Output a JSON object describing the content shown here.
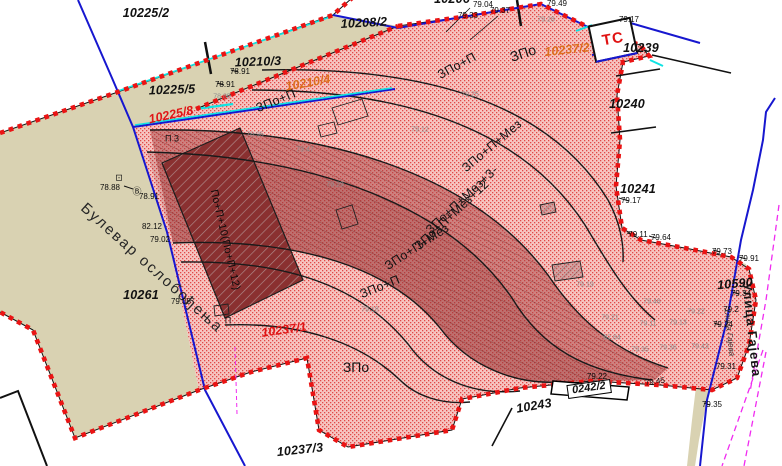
{
  "map": {
    "type": "cadastral-urban-plan",
    "colors": {
      "parcel_beige": "#d9d2b2",
      "plan_area_fill": "#f6c5c1",
      "plan_area_dots": "#e14848",
      "dense_zone_fill": "#a84040",
      "building_fill": "#8a3030",
      "boundary_dashes": "#ea1414",
      "cadastral_blue": "#1717cf",
      "cyan_line": "#0fe3e3",
      "magenta_line": "#f02bf0",
      "label_red": "#e01616",
      "label_orange": "#dc6e1c"
    },
    "labels": [
      {
        "t": "10225/2",
        "x": 146,
        "y": 13,
        "r": 0,
        "k": "p",
        "name": "parcel-label-10225-2"
      },
      {
        "t": "10206",
        "x": 452,
        "y": -1,
        "r": 0,
        "k": "p",
        "name": "parcel-label-10206-clipped"
      },
      {
        "t": "10208/2",
        "x": 364,
        "y": 23,
        "r": -3,
        "k": "p",
        "name": "parcel-label-10208-2"
      },
      {
        "t": "10210/3",
        "x": 258,
        "y": 62,
        "r": -2,
        "k": "p",
        "name": "parcel-label-10210-3"
      },
      {
        "t": "10225/5",
        "x": 172,
        "y": 90,
        "r": -2,
        "k": "p",
        "name": "parcel-label-10225-5"
      },
      {
        "t": "10225/8",
        "x": 171,
        "y": 115,
        "r": -12,
        "k": "pr",
        "name": "parcel-label-10225-8"
      },
      {
        "t": "10210/4",
        "x": 308,
        "y": 83,
        "r": -10,
        "k": "po",
        "name": "parcel-label-10210-4"
      },
      {
        "t": "10237/2",
        "x": 567,
        "y": 50,
        "r": -6,
        "k": "po",
        "name": "parcel-label-10237-2"
      },
      {
        "t": "10239",
        "x": 641,
        "y": 48,
        "r": 0,
        "k": "p",
        "name": "parcel-label-10239"
      },
      {
        "t": "10240",
        "x": 627,
        "y": 104,
        "r": 0,
        "k": "p",
        "name": "parcel-label-10240"
      },
      {
        "t": "10241",
        "x": 638,
        "y": 189,
        "r": 0,
        "k": "p",
        "name": "parcel-label-10241"
      },
      {
        "t": "10590",
        "x": 735,
        "y": 284,
        "r": -5,
        "k": "p",
        "name": "parcel-label-10590"
      },
      {
        "t": "10261",
        "x": 141,
        "y": 295,
        "r": 0,
        "k": "p",
        "name": "parcel-label-10261"
      },
      {
        "t": "10237/1",
        "x": 284,
        "y": 330,
        "r": -8,
        "k": "pr",
        "name": "parcel-label-10237-1"
      },
      {
        "t": "10237/3",
        "x": 300,
        "y": 450,
        "r": -6,
        "k": "p",
        "name": "parcel-label-10237-3"
      },
      {
        "t": "10243",
        "x": 534,
        "y": 406,
        "r": -10,
        "k": "p",
        "name": "parcel-label-10243"
      },
      {
        "t": "0242/2",
        "x": 589,
        "y": 389,
        "r": -8,
        "k": "bx",
        "name": "parcel-label-0242-2"
      },
      {
        "t": "ЗПо+П",
        "x": 276,
        "y": 101,
        "r": -22,
        "k": "z",
        "name": "zone-label"
      },
      {
        "t": "ЗПо+П",
        "x": 457,
        "y": 66,
        "r": -28,
        "k": "z",
        "name": "zone-label"
      },
      {
        "t": "ЗПо",
        "x": 523,
        "y": 53,
        "r": -18,
        "k": "zb",
        "name": "zone-label"
      },
      {
        "t": "ЗПо+П+Мез",
        "x": 492,
        "y": 146,
        "r": -40,
        "k": "z",
        "name": "zone-label"
      },
      {
        "t": "ЗПо+П+Мез+3-",
        "x": 462,
        "y": 200,
        "r": -43,
        "k": "z",
        "name": "zone-label"
      },
      {
        "t": "ЗПо+П+Мез+12",
        "x": 452,
        "y": 215,
        "r": -43,
        "k": "z",
        "name": "zone-label"
      },
      {
        "t": "ЗПо+П+Мез",
        "x": 417,
        "y": 247,
        "r": -33,
        "k": "z",
        "name": "zone-label"
      },
      {
        "t": "ЗПо+П",
        "x": 380,
        "y": 287,
        "r": -22,
        "k": "z",
        "name": "zone-label"
      },
      {
        "t": "ЗПо",
        "x": 356,
        "y": 367,
        "r": 0,
        "k": "zb",
        "name": "zone-label"
      },
      {
        "t": "П 3",
        "x": 172,
        "y": 139,
        "r": 0,
        "k": "f",
        "name": "floor-label"
      },
      {
        "t": "П",
        "x": 228,
        "y": 321,
        "r": 0,
        "k": "f",
        "name": "floor-label"
      },
      {
        "t": "По+П+10(По+П+12)",
        "x": 225,
        "y": 240,
        "r": 77,
        "k": "fb",
        "name": "building-zone-label"
      },
      {
        "t": "Булевар ослобођења",
        "x": 152,
        "y": 268,
        "r": 42,
        "k": "s1",
        "name": "street-label-bulevar-oslobodjenja"
      },
      {
        "t": "Улица Гајева",
        "x": 752,
        "y": 330,
        "r": 84,
        "k": "s2",
        "name": "street-label-ulica-gajeva"
      },
      {
        "t": "Улица Гајева",
        "x": 729,
        "y": 332,
        "r": 84,
        "k": "s3",
        "name": "street-label-ulica-gajeva-small"
      },
      {
        "t": "ТС",
        "x": 613,
        "y": 39,
        "r": -10,
        "k": "ts",
        "name": "transformer-station-label"
      },
      {
        "t": "79.04",
        "x": 483,
        "y": 5,
        "r": 0,
        "k": "e",
        "name": "elevation-label"
      },
      {
        "t": "79.33",
        "x": 468,
        "y": 16,
        "r": 0,
        "k": "e",
        "name": "elevation-label"
      },
      {
        "t": "79.37",
        "x": 500,
        "y": 11,
        "r": 0,
        "k": "e",
        "name": "elevation-label"
      },
      {
        "t": "79.49",
        "x": 557,
        "y": 4,
        "r": 0,
        "k": "e",
        "name": "elevation-label"
      },
      {
        "t": "79.17",
        "x": 629,
        "y": 20,
        "r": 0,
        "k": "e",
        "name": "elevation-label"
      },
      {
        "t": "78.88",
        "x": 110,
        "y": 188,
        "r": 0,
        "k": "e",
        "name": "elevation-label"
      },
      {
        "t": "78.91",
        "x": 149,
        "y": 197,
        "r": 0,
        "k": "e",
        "name": "elevation-label"
      },
      {
        "t": "78.91",
        "x": 240,
        "y": 72,
        "r": 0,
        "k": "e",
        "name": "elevation-label"
      },
      {
        "t": "78.91",
        "x": 225,
        "y": 85,
        "r": 0,
        "k": "e",
        "name": "elevation-label"
      },
      {
        "t": "78.85",
        "x": 222,
        "y": 97,
        "r": 0,
        "k": "eg",
        "name": "elevation-label"
      },
      {
        "t": "82.12",
        "x": 152,
        "y": 227,
        "r": 0,
        "k": "e",
        "name": "elevation-label"
      },
      {
        "t": "79.02",
        "x": 160,
        "y": 240,
        "r": 0,
        "k": "e",
        "name": "elevation-label"
      },
      {
        "t": "79.05",
        "x": 181,
        "y": 302,
        "r": 0,
        "k": "e",
        "name": "elevation-label"
      },
      {
        "t": "79.17",
        "x": 631,
        "y": 201,
        "r": 0,
        "k": "e",
        "name": "elevation-label"
      },
      {
        "t": "79.11",
        "x": 638,
        "y": 235,
        "r": 0,
        "k": "e",
        "name": "elevation-label"
      },
      {
        "t": "79.64",
        "x": 661,
        "y": 238,
        "r": 0,
        "k": "e",
        "name": "elevation-label"
      },
      {
        "t": "79.73",
        "x": 722,
        "y": 252,
        "r": 0,
        "k": "e",
        "name": "elevation-label"
      },
      {
        "t": "79.91",
        "x": 749,
        "y": 259,
        "r": 0,
        "k": "e",
        "name": "elevation-label"
      },
      {
        "t": "79.34",
        "x": 741,
        "y": 294,
        "r": 0,
        "k": "e",
        "name": "elevation-label"
      },
      {
        "t": "79.24",
        "x": 723,
        "y": 325,
        "r": 0,
        "k": "e",
        "name": "elevation-label"
      },
      {
        "t": "79.31",
        "x": 726,
        "y": 367,
        "r": 0,
        "k": "e",
        "name": "elevation-label"
      },
      {
        "t": "79.35",
        "x": 712,
        "y": 405,
        "r": 0,
        "k": "e",
        "name": "elevation-label"
      },
      {
        "t": "79.45",
        "x": 655,
        "y": 382,
        "r": -8,
        "k": "e",
        "name": "elevation-label"
      },
      {
        "t": "79.22",
        "x": 597,
        "y": 377,
        "r": 0,
        "k": "e",
        "name": "elevation-label"
      },
      {
        "t": "79.2",
        "x": 731,
        "y": 310,
        "r": 0,
        "k": "e",
        "name": "elevation-label"
      },
      {
        "t": "79.28",
        "x": 546,
        "y": 20,
        "r": 0,
        "k": "eg",
        "name": "elevation-label"
      },
      {
        "t": "79.21",
        "x": 610,
        "y": 318,
        "r": 0,
        "k": "eg",
        "name": "elevation-label"
      },
      {
        "t": "79.11",
        "x": 648,
        "y": 324,
        "r": 0,
        "k": "eg",
        "name": "elevation-label"
      },
      {
        "t": "79.13",
        "x": 678,
        "y": 323,
        "r": 0,
        "k": "eg",
        "name": "elevation-label"
      },
      {
        "t": "82.84",
        "x": 612,
        "y": 338,
        "r": 0,
        "k": "eg",
        "name": "elevation-label"
      },
      {
        "t": "79.35",
        "x": 640,
        "y": 350,
        "r": 0,
        "k": "eg",
        "name": "elevation-label"
      },
      {
        "t": "79.36",
        "x": 668,
        "y": 348,
        "r": 0,
        "k": "eg",
        "name": "elevation-label"
      },
      {
        "t": "79.43",
        "x": 700,
        "y": 347,
        "r": 0,
        "k": "eg",
        "name": "elevation-label"
      },
      {
        "t": "79.48",
        "x": 652,
        "y": 302,
        "r": 0,
        "k": "eg",
        "name": "elevation-label"
      },
      {
        "t": "79.22",
        "x": 696,
        "y": 312,
        "r": 0,
        "k": "eg",
        "name": "elevation-label"
      },
      {
        "t": "79.47",
        "x": 305,
        "y": 150,
        "r": 0,
        "k": "eg",
        "name": "elevation-label"
      },
      {
        "t": "79.18",
        "x": 370,
        "y": 310,
        "r": 0,
        "k": "eg",
        "name": "elevation-label"
      },
      {
        "t": "79.29",
        "x": 335,
        "y": 185,
        "r": 0,
        "k": "eg",
        "name": "elevation-label"
      },
      {
        "t": "79.12",
        "x": 420,
        "y": 130,
        "r": 0,
        "k": "eg",
        "name": "elevation-label"
      },
      {
        "t": "79.25",
        "x": 470,
        "y": 95,
        "r": 0,
        "k": "eg",
        "name": "elevation-label"
      },
      {
        "t": "79.19",
        "x": 585,
        "y": 285,
        "r": 0,
        "k": "eg",
        "name": "elevation-label"
      },
      {
        "t": "78.95",
        "x": 255,
        "y": 135,
        "r": 0,
        "k": "eg",
        "name": "elevation-label"
      },
      {
        "t": "⊡",
        "x": 119,
        "y": 178,
        "r": 0,
        "k": "f",
        "name": "survey-symbol"
      },
      {
        "t": "Ⓑ",
        "x": 137,
        "y": 192,
        "r": 0,
        "k": "f",
        "name": "benchmark-symbol"
      }
    ]
  }
}
